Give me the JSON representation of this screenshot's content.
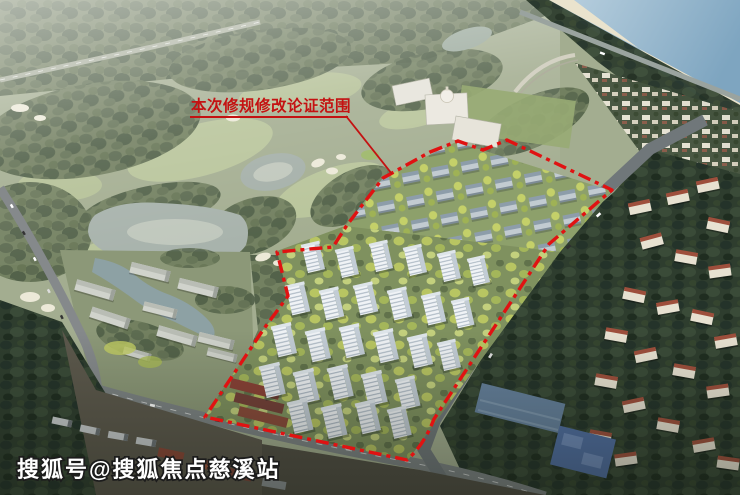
{
  "annotation": {
    "label": "本次修规修改论证范围"
  },
  "watermark": {
    "text": "搜狐号@搜狐焦点慈溪站"
  },
  "palette": {
    "boundary_red": "#e01212",
    "annotation_red": "#c41212",
    "watermark_white": "#ffffff",
    "sea_blue": "#8fb3cc",
    "beach_sand": "#eae3cd",
    "golf_green": "#a3ad90",
    "fairway_green": "#b8c49a",
    "forest_green": "#55644a",
    "dark_forest_green": "#2e3d2e",
    "tree_yellow": "#c2cd63",
    "tower_white": "#eff2f5",
    "lake_grey": "#a7b2ab",
    "red_roof": "#9e4f3c",
    "blue_roof": "#647f9b",
    "court_blue": "#4f6da0",
    "road_grey": "#7d8384",
    "industrial_ground": "#5c584c",
    "container_red": "#8a4636"
  }
}
